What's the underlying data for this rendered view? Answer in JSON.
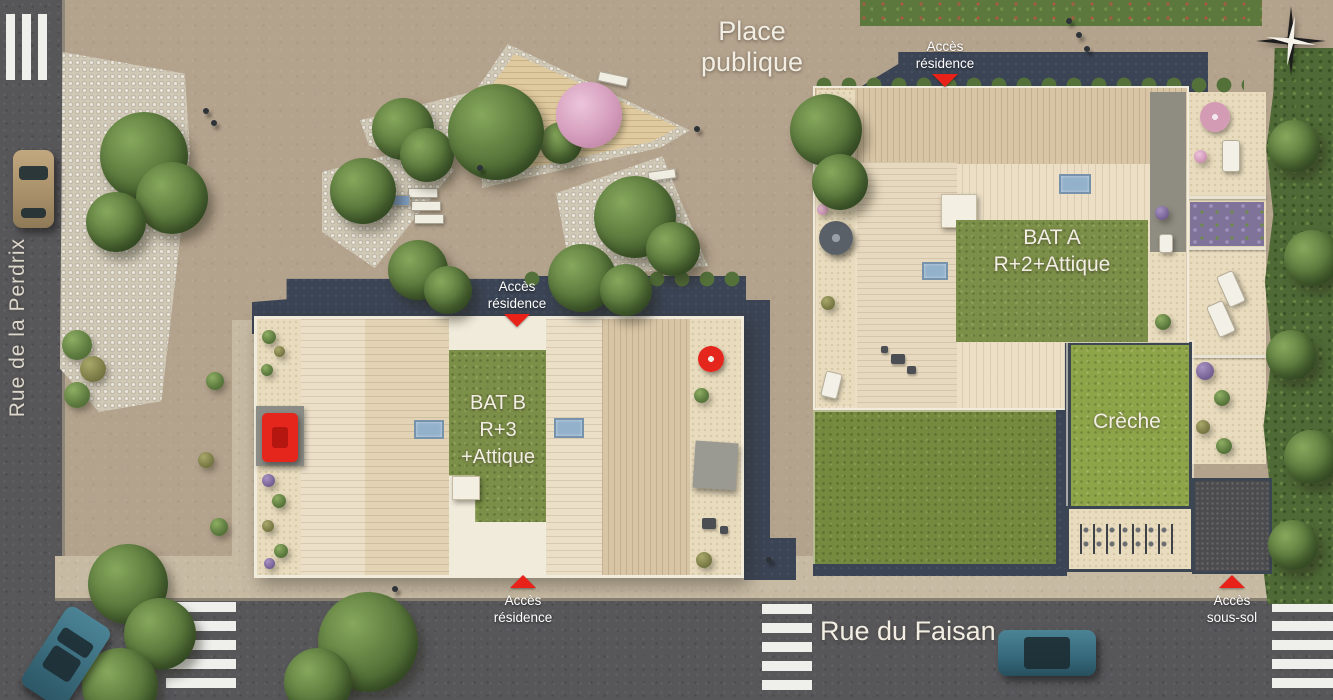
{
  "plan": {
    "plaza": {
      "line1": "Place",
      "line2": "publique"
    },
    "streets": {
      "perdrix": "Rue de la Perdrix",
      "faisan": "Rue du Faisan"
    },
    "buildings": {
      "bat_a": {
        "line1": "BAT A",
        "line2": "R+2+Attique"
      },
      "bat_b": {
        "line1": "BAT B",
        "line2": "R+3",
        "line3": "+Attique"
      },
      "creche": "Crèche"
    },
    "access": {
      "top": {
        "line1": "Accès",
        "line2": "résidence"
      },
      "mid": {
        "line1": "Accès",
        "line2": "résidence"
      },
      "bottom": {
        "line1": "Accès",
        "line2": "résidence"
      },
      "sous_sol": {
        "line1": "Accès",
        "line2": "sous-sol"
      }
    },
    "icons": {
      "compass": "compass-rose-icon",
      "access_arrow": "red-triangle-arrow-icon"
    },
    "colors": {
      "asphalt": "#57575a",
      "ground": "#b3a28c",
      "sidewalk": "#c7baa3",
      "cobble": "#d1c9b7",
      "sand": "#e9dcbe",
      "roof_light": "#ebdfc8",
      "roof_dark": "#d8c5a6",
      "green_roof": "#7c8f48",
      "lawn": "#75893f",
      "creche_roof": "#8ea449",
      "navy_path": "#3b4454",
      "accent_red": "#e92219",
      "hedge": "#4f6a36",
      "deck": "#dfc99e"
    }
  }
}
